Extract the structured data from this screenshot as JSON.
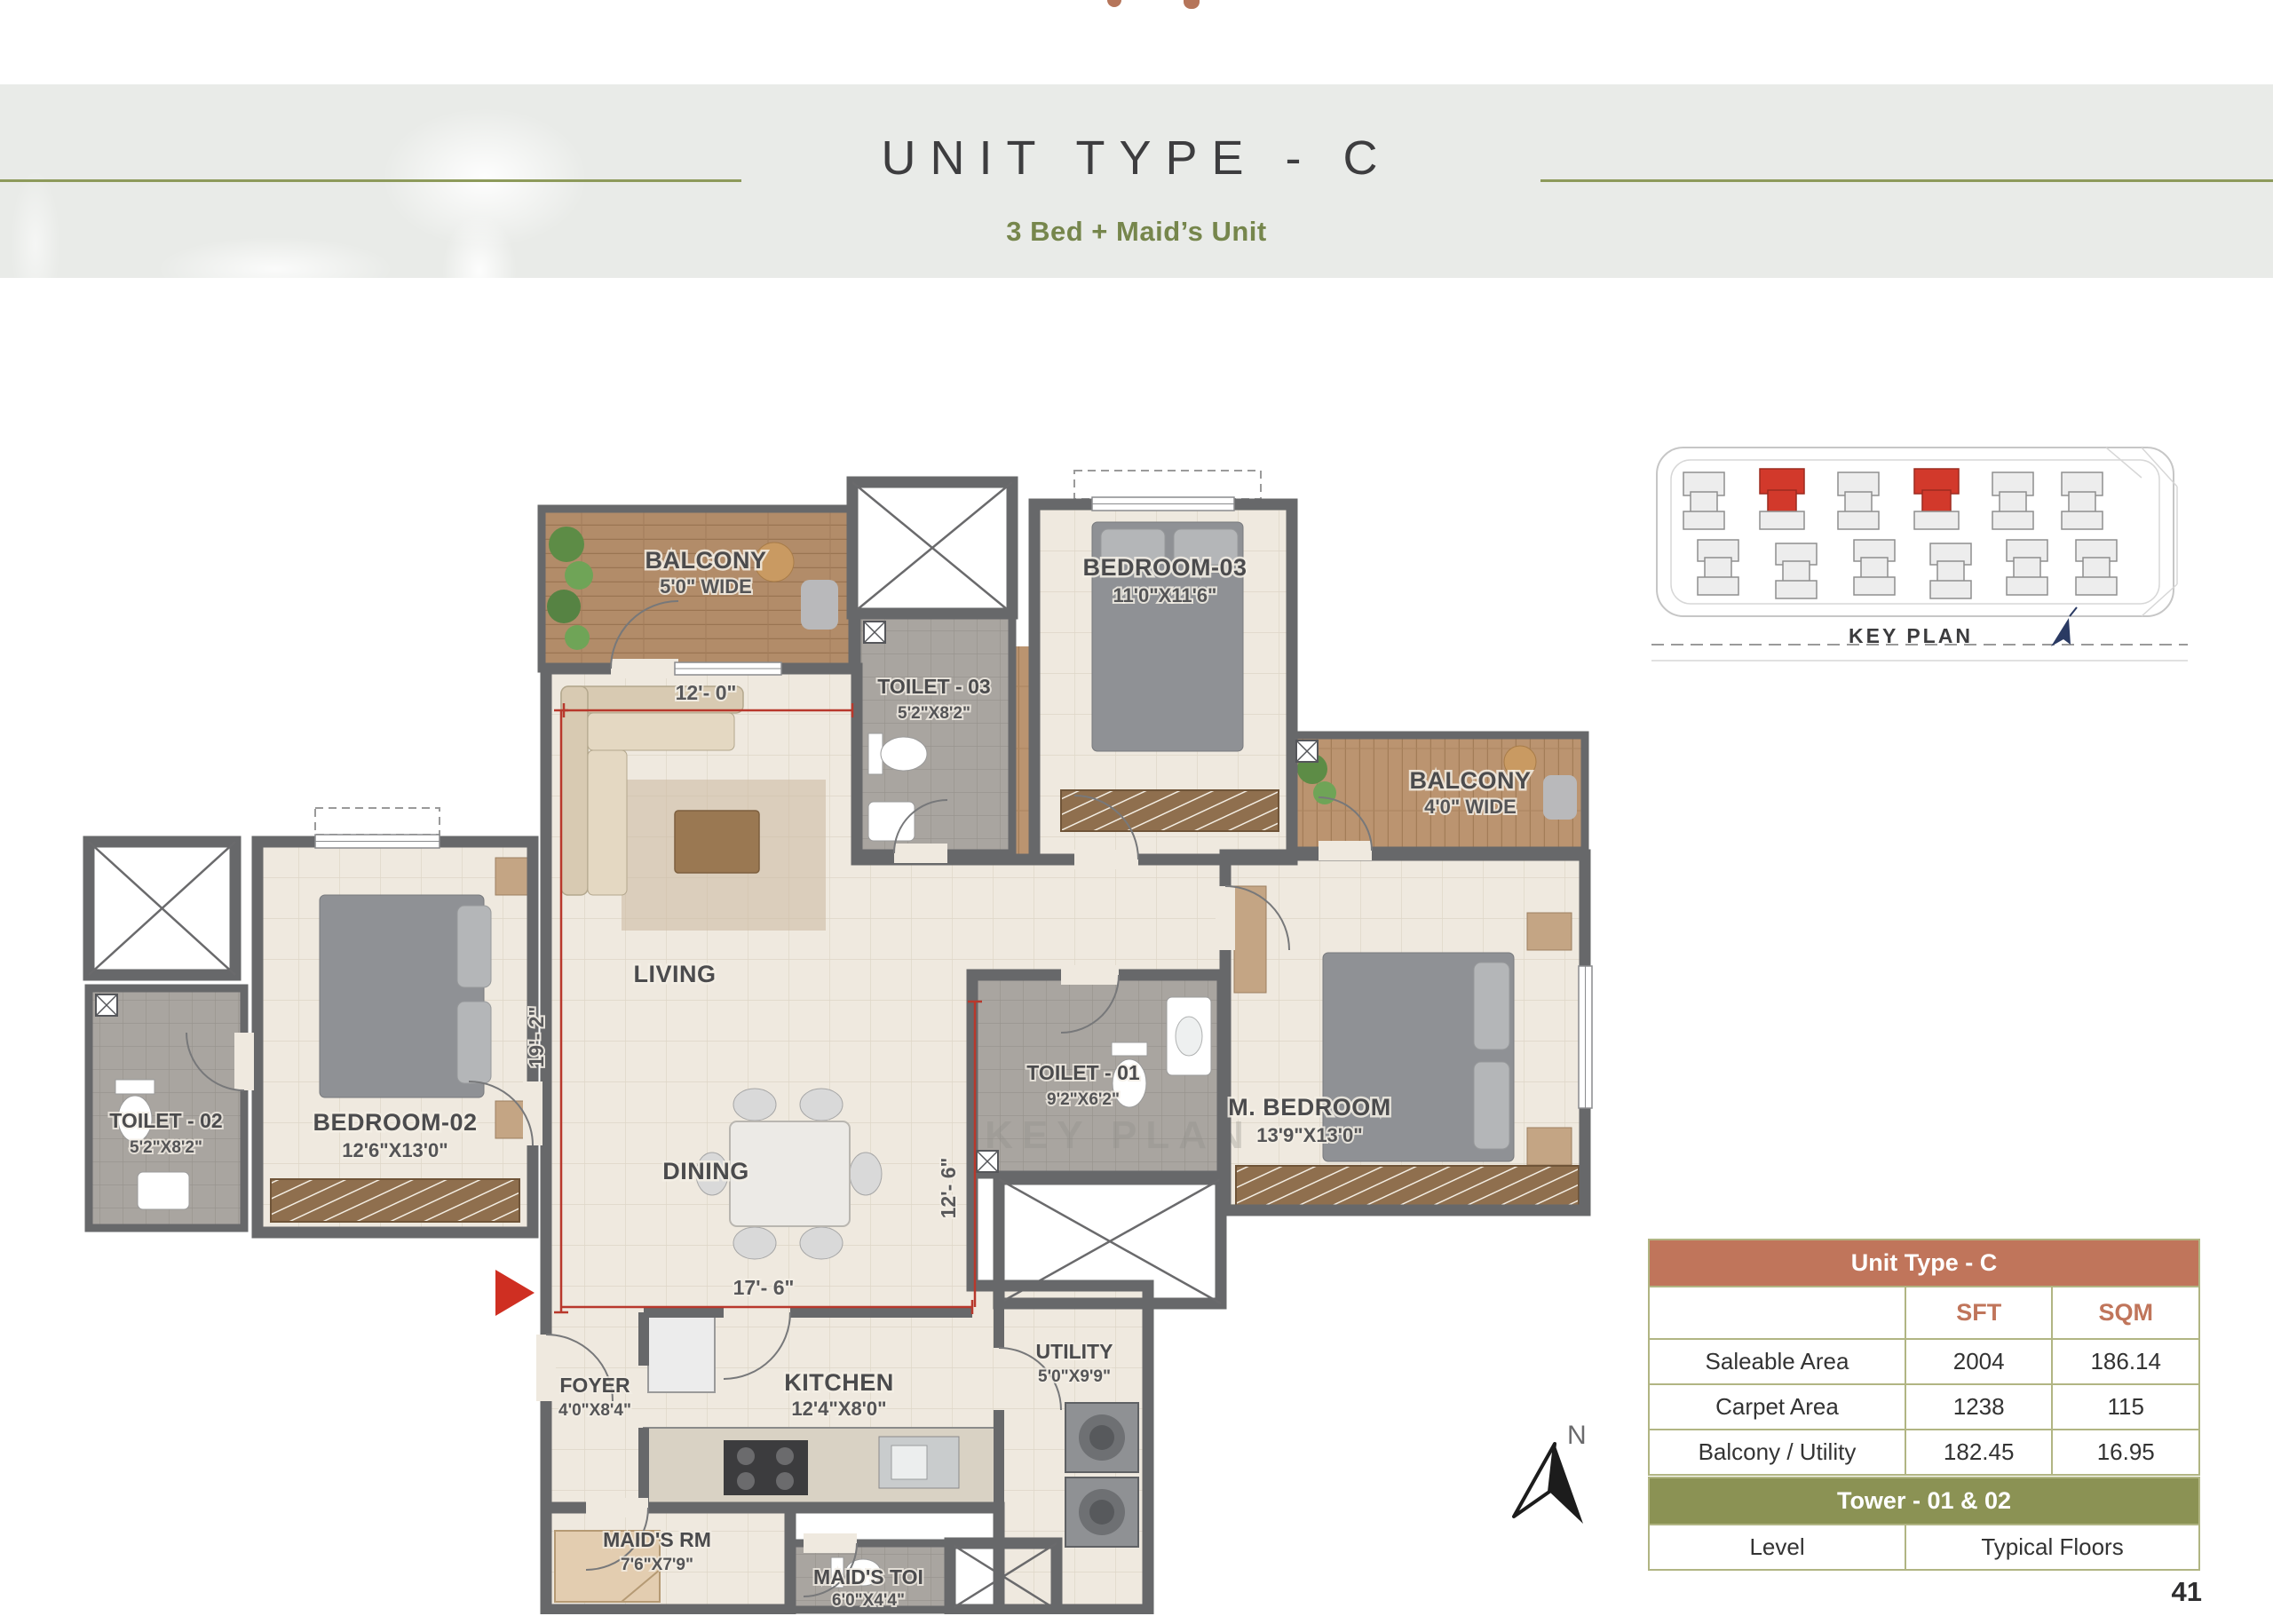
{
  "page_number": "41",
  "header": {
    "title": "UNIT TYPE - C",
    "subtitle": "3 Bed + Maid’s Unit"
  },
  "key_plan": {
    "label": "KEY PLAN"
  },
  "compass": {
    "label": "N"
  },
  "plan": {
    "watermark": "KEY PLAN",
    "rooms": [
      {
        "name": "BALCONY",
        "dim": "5'0\" WIDE"
      },
      {
        "name": "TOILET - 03",
        "dim": "5'2\"X8'2\""
      },
      {
        "name": "BEDROOM-03",
        "dim": "11'0\"X11'6\""
      },
      {
        "name": "BALCONY",
        "dim": "4'0\" WIDE"
      },
      {
        "name": "M. BEDROOM",
        "dim": "13'9\"X13'0\""
      },
      {
        "name": "TOILET - 01",
        "dim": "9'2\"X6'2\""
      },
      {
        "name": "LIVING",
        "dim": ""
      },
      {
        "name": "DINING",
        "dim": ""
      },
      {
        "name": "TOILET - 02",
        "dim": "5'2\"X8'2\""
      },
      {
        "name": "BEDROOM-02",
        "dim": "12'6\"X13'0\""
      },
      {
        "name": "FOYER",
        "dim": "4'0\"X8'4\""
      },
      {
        "name": "KITCHEN",
        "dim": "12'4\"X8'0\""
      },
      {
        "name": "UTILITY",
        "dim": "5'0\"X9'9\""
      },
      {
        "name": "MAID'S RM",
        "dim": "7'6\"X7'9\""
      },
      {
        "name": "MAID'S TOI",
        "dim": "6'0\"X4'4\""
      }
    ],
    "dims": {
      "living_w": "12'- 0\"",
      "living_h": "19'- 2\"",
      "dining_w": "17'- 6\"",
      "dining_h": "12'- 6\""
    }
  },
  "area_table": {
    "title": "Unit Type - C",
    "unit_headers": [
      "SFT",
      "SQM"
    ],
    "rows": [
      {
        "label": "Saleable Area",
        "sft": "2004",
        "sqm": "186.14"
      },
      {
        "label": "Carpet Area",
        "sft": "1238",
        "sqm": "115"
      },
      {
        "label": "Balcony / Utility",
        "sft": "182.45",
        "sqm": "16.95"
      }
    ]
  },
  "tower_table": {
    "title": "Tower - 01 & 02",
    "columns": [
      "Level",
      "Typical Floors"
    ]
  },
  "colors": {
    "terracotta": "#c0755b",
    "olive": "#8b9254",
    "line_olive": "#8d9a5b",
    "red_accent": "#cf2f22"
  }
}
